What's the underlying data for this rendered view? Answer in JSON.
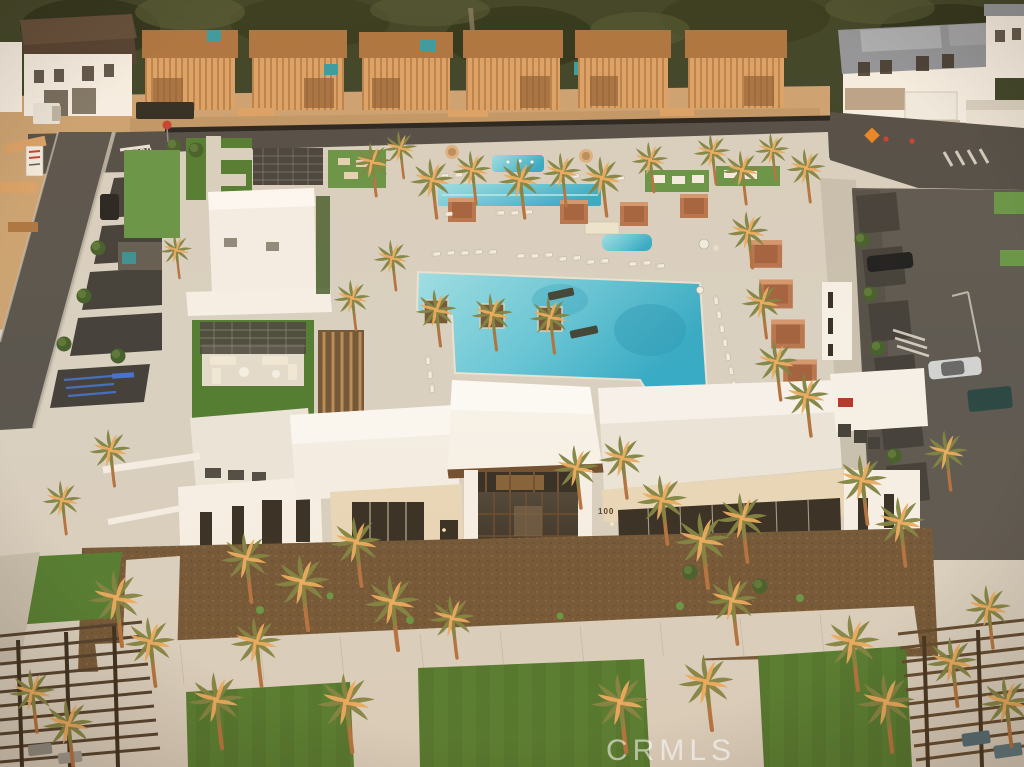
{
  "image": {
    "type": "aerial-photograph",
    "description": "Sunset aerial view of a new-home community amenity center: resort pools with palm trees and terracotta cabanas, white modern clubhouse, lawns and pergolas, homes under wood-frame construction along the back street",
    "watermark": "CRMLS"
  },
  "labels": {
    "clubhouse_address": "100",
    "road_marking_stop": "STOP"
  },
  "palette": {
    "foliage": "#333d23",
    "foliage2": "#4a5430",
    "dirt": "#c9a171",
    "dirt2": "#b48a5c",
    "wood": "#d9a065",
    "wood2": "#a9713d",
    "road": "#4b4945",
    "road2": "#57544e",
    "parking": "#3c3a36",
    "concrete": "#d7d0c2",
    "concrete2": "#c6bfb0",
    "paver": "#e2dbcc",
    "pool": "#62c5d8",
    "pool2": "#9adfe8",
    "pool3": "#2fa9c6",
    "lawn": "#4c7a2e",
    "lawn2": "#629344",
    "lawn3": "#3c671f",
    "mulch": "#6d5334",
    "mulch2": "#59422a",
    "white": "#f5f1e9",
    "roof": "#eae5da",
    "roof2": "#f3efe7",
    "cream": "#e7d7ba",
    "stone": "#b7a189",
    "terra": "#b5714b",
    "terra2": "#8e4f2f",
    "glass": "#2f2921",
    "bronze": "#6b4a2c",
    "grayroof": "#8b929b",
    "teal": "#2e9aa3",
    "red": "#c33b2e",
    "blue": "#3f6fd0",
    "orange": "#e8821e",
    "treeG": "#3f5b28",
    "fence": "#23231f",
    "trunk": "#c9854f",
    "frondG": "#7b8140",
    "frondO": "#eaaa5e",
    "watermark": "#ffffff"
  }
}
